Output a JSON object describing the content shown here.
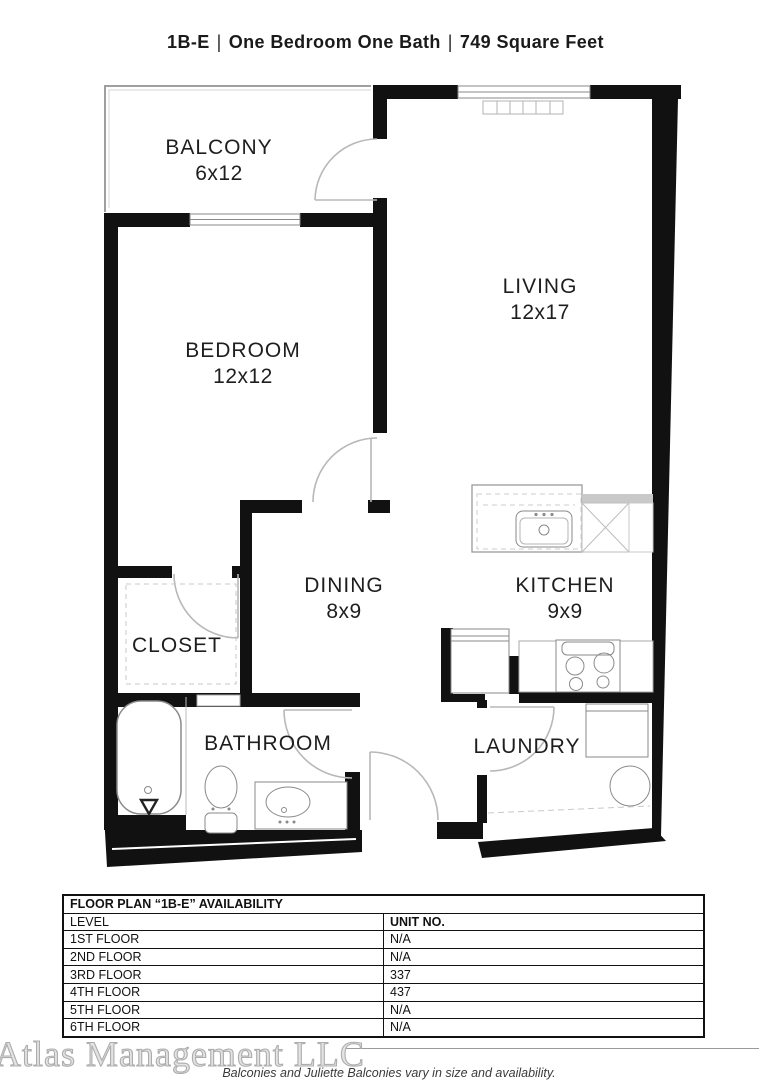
{
  "header": {
    "unit": "1B-E",
    "separator": "|",
    "type": "One Bedroom One Bath",
    "area": "749 Square Feet"
  },
  "rooms": [
    {
      "name": "BALCONY",
      "dims": "6x12"
    },
    {
      "name": "LIVING",
      "dims": "12x17"
    },
    {
      "name": "BEDROOM",
      "dims": "12x12"
    },
    {
      "name": "DINING",
      "dims": "8x9"
    },
    {
      "name": "KITCHEN",
      "dims": "9x9"
    },
    {
      "name": "CLOSET",
      "dims": ""
    },
    {
      "name": "BATHROOM",
      "dims": ""
    },
    {
      "name": "LAUNDRY",
      "dims": ""
    }
  ],
  "availability": {
    "title": "FLOOR PLAN “1B-E” AVAILABILITY",
    "columns": [
      "LEVEL",
      "UNIT NO."
    ],
    "rows": [
      {
        "level": "1ST FLOOR",
        "unit": "N/A"
      },
      {
        "level": "2ND FLOOR",
        "unit": "N/A"
      },
      {
        "level": "3RD FLOOR",
        "unit": "337"
      },
      {
        "level": "4TH FLOOR",
        "unit": "437"
      },
      {
        "level": "5TH FLOOR",
        "unit": "N/A"
      },
      {
        "level": "6TH FLOOR",
        "unit": "N/A"
      }
    ]
  },
  "footer": {
    "watermark": "Atlas Management LLC",
    "note": "Balconies and Juliette Balconies vary in size and availability."
  },
  "colors": {
    "wall": "#111111",
    "thin_line": "#9f9f9f",
    "fixture": "#8a8a8a",
    "dashed": "#c8c8c8",
    "door": "#b8b8b8",
    "text": "#1e1e1e",
    "watermark": "#adadad"
  }
}
